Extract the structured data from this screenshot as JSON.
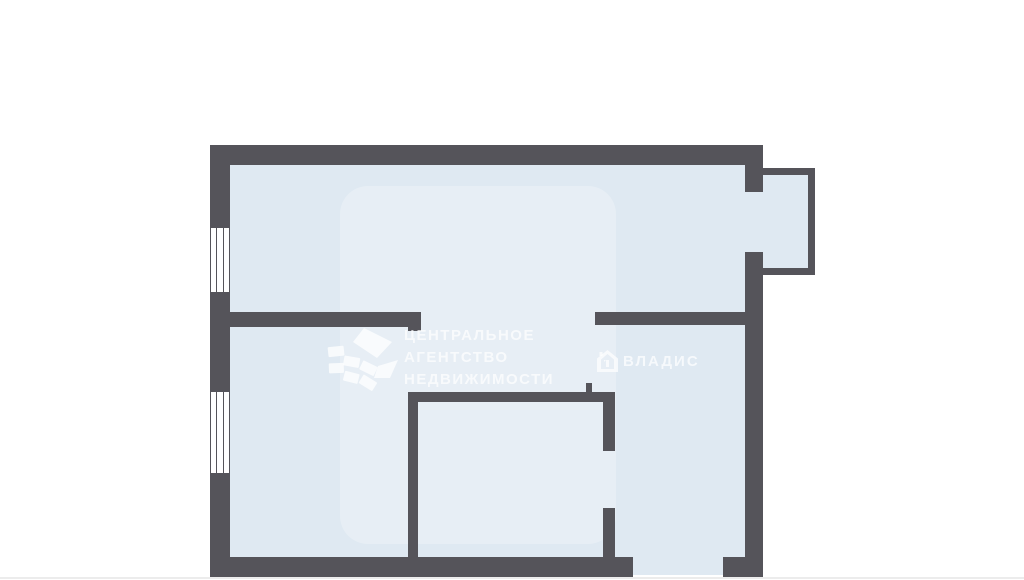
{
  "palette": {
    "wall": "#55545A",
    "floor": "#dfe9f2",
    "watermark": "rgba(255,255,255,0.72)",
    "page_background": "#ffffff",
    "image_bottom_border": "#ececec"
  },
  "watermarks": {
    "agency": {
      "logo_icon": "ribbon-logo",
      "lines": [
        "ЦЕНТРАЛЬНОЕ",
        "АГЕНТСТВО",
        "НЕДВИЖИМОСТИ"
      ]
    },
    "vladis": {
      "icon": "house-icon",
      "label": "ВЛАДИС"
    }
  },
  "floorplan": {
    "floors": [
      {
        "name": "floor-main-area",
        "x": 230,
        "y": 165,
        "w": 515,
        "h": 392
      },
      {
        "name": "floor-balcony-doorway",
        "x": 745,
        "y": 192,
        "w": 18,
        "h": 60
      },
      {
        "name": "floor-balcony",
        "x": 763,
        "y": 175,
        "w": 45,
        "h": 93
      },
      {
        "name": "floor-entrance-doorway",
        "x": 633,
        "y": 557,
        "w": 90,
        "h": 18
      }
    ],
    "walls": [
      {
        "name": "outer-wall-top",
        "x": 210,
        "y": 145,
        "w": 553,
        "h": 20
      },
      {
        "name": "outer-wall-left",
        "x": 210,
        "y": 145,
        "w": 20,
        "h": 432
      },
      {
        "name": "outer-wall-bottom-left-segment",
        "x": 210,
        "y": 557,
        "w": 423,
        "h": 20
      },
      {
        "name": "outer-wall-bottom-right-segment",
        "x": 723,
        "y": 557,
        "w": 40,
        "h": 20
      },
      {
        "name": "outer-wall-right-upper",
        "x": 745,
        "y": 145,
        "w": 18,
        "h": 47
      },
      {
        "name": "outer-wall-right-lower",
        "x": 745,
        "y": 252,
        "w": 18,
        "h": 325
      },
      {
        "name": "balcony-wall-top",
        "x": 763,
        "y": 168,
        "w": 52,
        "h": 7
      },
      {
        "name": "balcony-wall-right",
        "x": 808,
        "y": 168,
        "w": 7,
        "h": 107
      },
      {
        "name": "balcony-wall-bottom",
        "x": 763,
        "y": 268,
        "w": 52,
        "h": 7
      },
      {
        "name": "interior-wall-top-room-left",
        "x": 230,
        "y": 312,
        "w": 178,
        "h": 15
      },
      {
        "name": "door-jamb-top-room",
        "x": 408,
        "y": 312,
        "w": 13,
        "h": 19
      },
      {
        "name": "interior-wall-top-room-right",
        "x": 595,
        "y": 312,
        "w": 150,
        "h": 13
      },
      {
        "name": "interior-wall-left-room-right",
        "x": 408,
        "y": 393,
        "w": 10,
        "h": 164
      },
      {
        "name": "interior-wall-middle-room-top",
        "x": 408,
        "y": 392,
        "w": 207,
        "h": 10
      },
      {
        "name": "door-jamb-middle-room-top",
        "x": 586,
        "y": 383,
        "w": 6,
        "h": 10
      },
      {
        "name": "interior-wall-middle-room-right-upper",
        "x": 603,
        "y": 392,
        "w": 12,
        "h": 59
      },
      {
        "name": "interior-wall-middle-room-right-lower",
        "x": 603,
        "y": 508,
        "w": 12,
        "h": 49
      }
    ],
    "windows": [
      {
        "name": "window-top-left",
        "x": 210,
        "y": 228,
        "w": 20,
        "h": 64
      },
      {
        "name": "window-bottom-left",
        "x": 210,
        "y": 392,
        "w": 20,
        "h": 81
      }
    ]
  }
}
